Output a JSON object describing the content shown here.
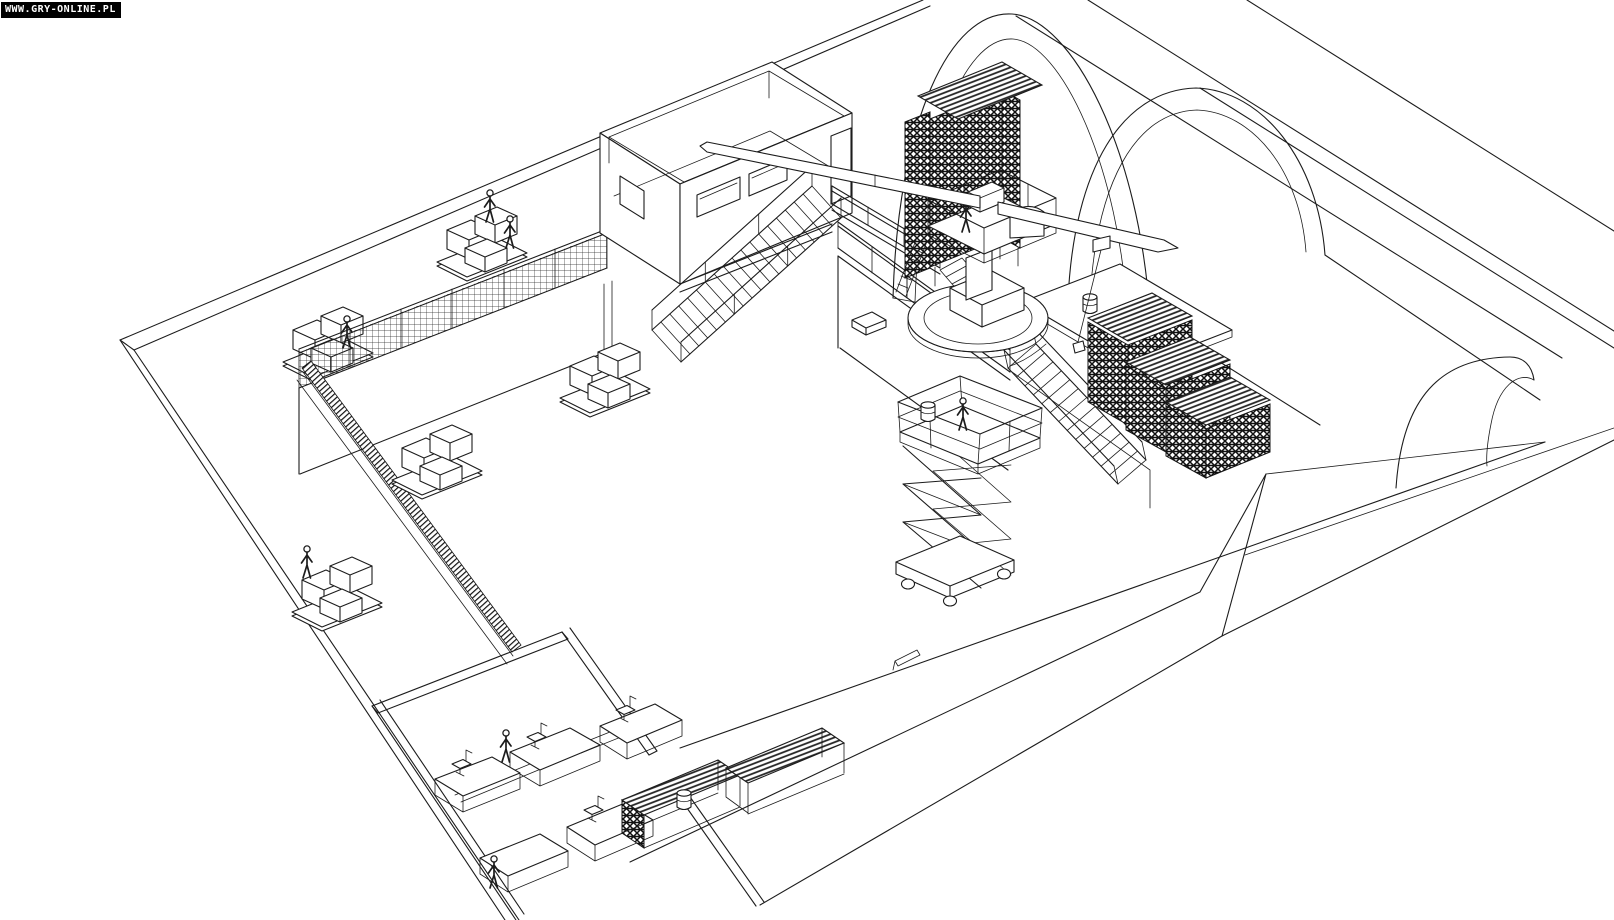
{
  "watermark": {
    "text": "WWW.GRY-ONLINE.PL",
    "bg_color": "#000000",
    "text_color": "#ffffff"
  },
  "canvas": {
    "width": 1614,
    "height": 920,
    "background": "#ffffff",
    "line_color": "#1c1c1c"
  },
  "scene": {
    "type": "isometric-wireframe-line-drawing",
    "objects": [
      {
        "name": "warehouse-hall-shell"
      },
      {
        "name": "tunnel-vault-large"
      },
      {
        "name": "tunnel-vault-small"
      },
      {
        "name": "end-wall-arch-doorway"
      },
      {
        "name": "mezzanine-with-mesh-railing"
      },
      {
        "name": "control-room-box"
      },
      {
        "name": "main-staircase"
      },
      {
        "name": "catwalk-bridge"
      },
      {
        "name": "raised-platform-railing"
      },
      {
        "name": "platform-staircase"
      },
      {
        "name": "scaffold-tower"
      },
      {
        "name": "pedestal-crane-with-booms"
      },
      {
        "name": "crane-turntable"
      },
      {
        "name": "scissor-lift"
      },
      {
        "name": "stepped-work-platforms"
      },
      {
        "name": "pallet-racks"
      },
      {
        "name": "crate-pallets"
      },
      {
        "name": "office-rooms-with-desks"
      },
      {
        "name": "worker-figures"
      },
      {
        "name": "barrels"
      }
    ]
  }
}
